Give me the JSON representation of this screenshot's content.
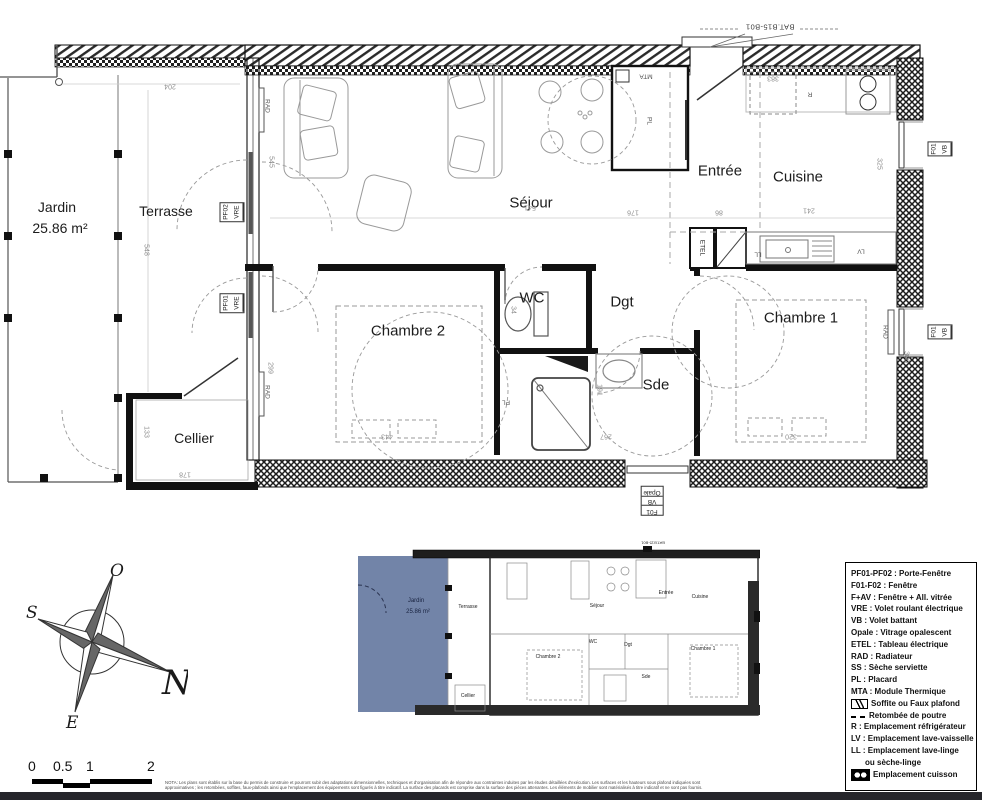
{
  "sheet": {
    "bat_label": "BAT.B15-B01"
  },
  "rooms": {
    "jardin": "Jardin",
    "jardin_area": "25.86 m²",
    "terrasse": "Terrasse",
    "sejour": "Séjour",
    "entree": "Entrée",
    "cuisine": "Cuisine",
    "wc": "WC",
    "dgt": "Dgt",
    "sde": "Sde",
    "chambre1": "Chambre 1",
    "chambre2": "Chambre 2",
    "cellier": "Cellier"
  },
  "dims": {
    "d204": "204",
    "d548": "548",
    "d545": "545",
    "d541": "541",
    "d176": "176",
    "d86": "86",
    "d383": "383",
    "d241": "241",
    "d325": "325",
    "d299": "299",
    "d443": "443",
    "d34": "34",
    "d191": "191",
    "d267": "267",
    "d320": "320",
    "d300": "300",
    "d133": "133",
    "d178": "178"
  },
  "fixtures": {
    "rad": "RAD",
    "etel": "ETEL",
    "pl": "PL",
    "mta": "MTA",
    "ll": "LL",
    "lv": "LV",
    "r": "R"
  },
  "windows": {
    "pf01": "PF01",
    "pf02": "PF02",
    "vre": "VRE",
    "f01": "F01",
    "vb": "VB",
    "opale": "Opale"
  },
  "compass": {
    "n": "N",
    "s": "S",
    "e": "E",
    "o": "O"
  },
  "scalebar": {
    "t0": "0",
    "t05": "0.5",
    "t1": "1",
    "t2": "2"
  },
  "legend": {
    "items": [
      {
        "label": "PF01-PF02 : Porte-Fenêtre"
      },
      {
        "label": "F01-F02 : Fenêtre"
      },
      {
        "label": "F+AV : Fenêtre + All. vitrée"
      },
      {
        "label": "VRE : Volet roulant électrique"
      },
      {
        "label": "VB : Volet battant"
      },
      {
        "label": "Opale : Vitrage opalescent"
      },
      {
        "label": "ETEL : Tableau électrique"
      },
      {
        "label": "RAD : Radiateur"
      },
      {
        "label": "SS : Sèche serviette"
      },
      {
        "label": "PL : Placard"
      },
      {
        "label": "MTA : Module Thermique"
      },
      {
        "label": "Soffite ou Faux plafond",
        "icon": "soffite"
      },
      {
        "label": "Retombée de poutre",
        "icon": "beam"
      },
      {
        "label": "R : Emplacement réfrigérateur"
      },
      {
        "label": "LV : Emplacement lave-vaisselle"
      },
      {
        "label": "LL : Emplacement lave-linge",
        "label2": "ou sèche-linge"
      },
      {
        "label": "Emplacement cuisson",
        "icon": "cuisson"
      }
    ]
  },
  "nota": {
    "line1": "NOTA: Les plans sont établis sur la base du permis de construire et pourront subir des adaptations dimensionnelles, techniques et d'organisation afin de répondre aux contraintes induites par les études détaillées d'exécution. Les surfaces et les hauteurs sous plafond indiquées sont",
    "line2": "approximatives ; les retombées, soffites, faux-plafonds ainsi que l'emplacement des équipements sont figurés à titre indicatif. La surface des placards est comprise dans la surface des pièces attenantes. Les éléments de mobilier sont matérialisés à titre indicatif et ne sont pas fournis."
  },
  "colors": {
    "jardin_blue": "#7284a8"
  }
}
